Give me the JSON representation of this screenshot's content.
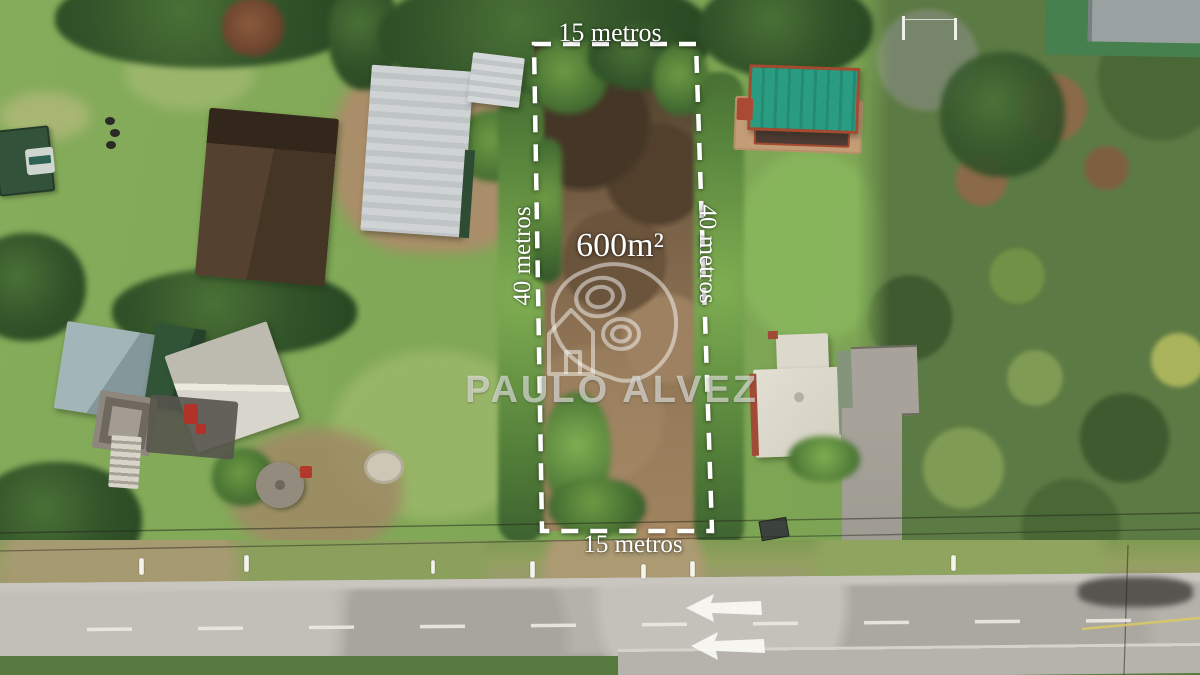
{
  "photo": {
    "kind": "aerial-drone-photo",
    "subject": "vacant land plot outlined for sale beside a rural road"
  },
  "plot_annotation": {
    "area": "600m²",
    "front_width_top": "15 metros",
    "front_width_bottom": "15 metros",
    "depth_left": "40 metros",
    "depth_right": "40 metros",
    "outline": {
      "style": "dashed",
      "color": "#ffffff"
    }
  },
  "watermark": {
    "brand": "PAULO ALVEZ",
    "logo": "house-location-pin-logo"
  },
  "road_markings": {
    "arrow_count": 2,
    "arrow_direction": "left",
    "center_line": "white-dashed",
    "edge_line_color": "#d9c867"
  },
  "palette": {
    "grass": "#83aa58",
    "scrub": "#5c7a43",
    "plot_dirt": "#8b6f51",
    "road": "#b5b2ac",
    "tree": "#33552a",
    "teal_roof": "#2a9c82",
    "brown_roof": "#4a3726",
    "metal_roof": "#c7cbcd",
    "white_roof": "#dcd8cb",
    "blue_gray_roof": "#9fb3b6",
    "marking_white": "#f2f1ea"
  }
}
